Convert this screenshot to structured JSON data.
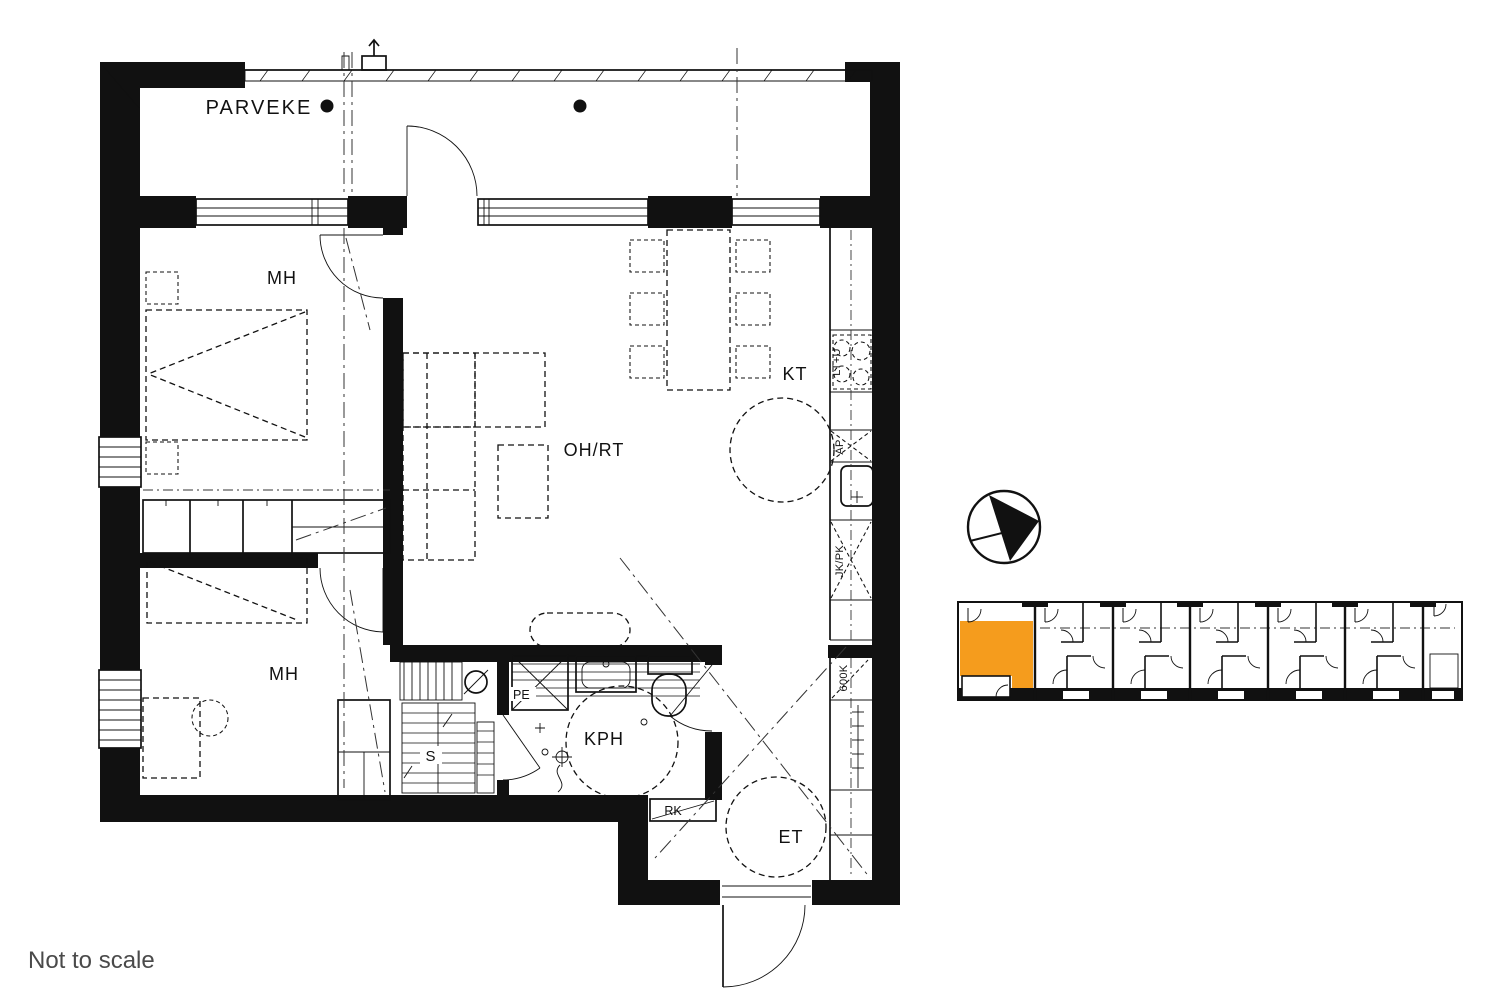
{
  "floor_plan": {
    "room_labels": {
      "balcony": "PARVEKE",
      "bedroom_top": "MH",
      "bedroom_bottom": "MH",
      "living_room": "OH/RT",
      "kitchen": "KT",
      "bathroom": "KPH",
      "sauna": "S",
      "entry": "ET"
    },
    "fixture_labels": {
      "stove": "LT+U",
      "dishwasher": "AP",
      "fridge_freezer": "JK/PK",
      "washing_machine": "PE",
      "distribution_board": "RK",
      "tall_cabinet": "600K"
    }
  },
  "site_plan": {
    "highlight_color": "#F59C1D"
  },
  "icons": {
    "north_arrow": "north-arrow-icon"
  },
  "colors": {
    "line": "#111111",
    "muted_text": "#4a4a4a",
    "highlight": "#F59C1D"
  },
  "footer": {
    "disclaimer": "Not to scale"
  }
}
